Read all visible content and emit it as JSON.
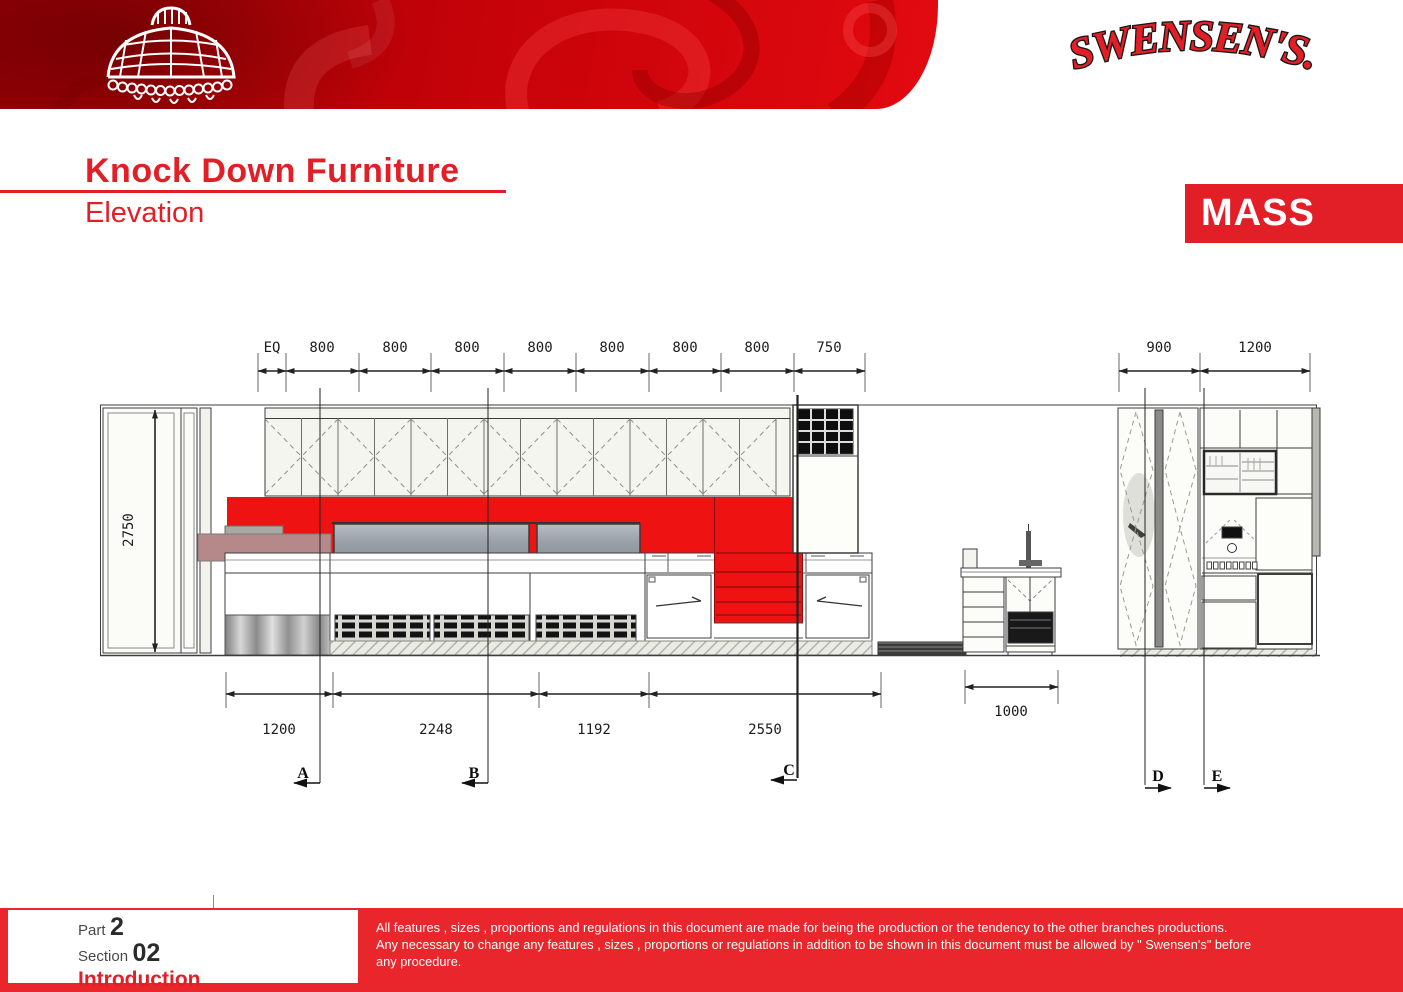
{
  "page": {
    "brand": "SWENSEN'S.",
    "title": "Knock Down Furniture",
    "subtitle": "Elevation",
    "badge": "MASS"
  },
  "drawing": {
    "top_dimensions": [
      "EQ",
      "800",
      "800",
      "800",
      "800",
      "800",
      "800",
      "800",
      "750"
    ],
    "right_dimensions": [
      "900",
      "1200"
    ],
    "height_dimension": "2750",
    "bottom_dimensions": [
      "1200",
      "2248",
      "1192",
      "2550"
    ],
    "station_dimension": "1000",
    "section_markers": [
      "A",
      "B",
      "C",
      "D",
      "E"
    ]
  },
  "footer": {
    "part_label": "Part",
    "part_number": "2",
    "section_label": "Section",
    "section_number": "02",
    "chapter_title": "Introduction",
    "disclaimer_lines": [
      "All features , sizes , proportions and regulations in this document are made for being the production or the tendency to the other branches productions.",
      "Any necessary to change any features , sizes , proportions or regulations in addition to be shown in this document must be allowed by \" Swensen's\" before",
      "any procedure."
    ]
  },
  "colors": {
    "accent_red": "#e21e26",
    "drawing_red": "#ee1212",
    "footer_red": "#e8262c",
    "header_red_dark": "#9c0005",
    "header_red_bright": "#e20a10"
  }
}
